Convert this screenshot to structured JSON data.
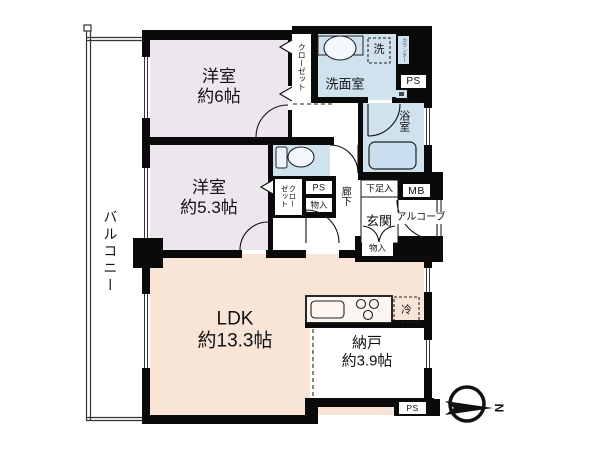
{
  "floorplan": {
    "rooms": {
      "bedroom1": {
        "label": "洋室\n約6帖"
      },
      "bedroom2": {
        "label": "洋室\n約5.3帖"
      },
      "ldk": {
        "label": "LDK\n約13.3帖"
      },
      "storage_room": {
        "label": "納戸\n約3.9帖"
      },
      "balcony": {
        "label": "バルコニー"
      },
      "washroom": {
        "label": "洗面室"
      },
      "bathroom": {
        "label": "浴室"
      },
      "hallway": {
        "label": "廊下"
      },
      "entrance": {
        "label": "玄関"
      },
      "alcove": {
        "label": "アルコーブ"
      }
    },
    "closets": {
      "closet_bedroom1": {
        "label": "クローゼット"
      },
      "closet_bedroom2": {
        "label": "クロー\nゼット"
      }
    },
    "fixtures": {
      "washing_machine": {
        "label": "洗"
      },
      "counter": {
        "label": "カウンター"
      },
      "refrigerator": {
        "label": "冷"
      },
      "shoe_cabinet": {
        "label": "下足入"
      },
      "meter_box": {
        "label": "MB"
      },
      "storage_hall": {
        "label": "物入"
      },
      "storage_entrance": {
        "label": "物入"
      },
      "pipe_space_top": {
        "label": "PS"
      },
      "pipe_space_mid": {
        "label": "PS"
      },
      "pipe_space_bottom": {
        "label": "PS"
      }
    },
    "compass": {
      "north": "N"
    },
    "colors": {
      "bedroom_fill": "#ece7ed",
      "ldk_fill": "#f8e5d7",
      "wet_area_fill": "#cfe2ee",
      "bathtub_fill": "#c9dff0",
      "wall": "#0a0a0a"
    }
  }
}
